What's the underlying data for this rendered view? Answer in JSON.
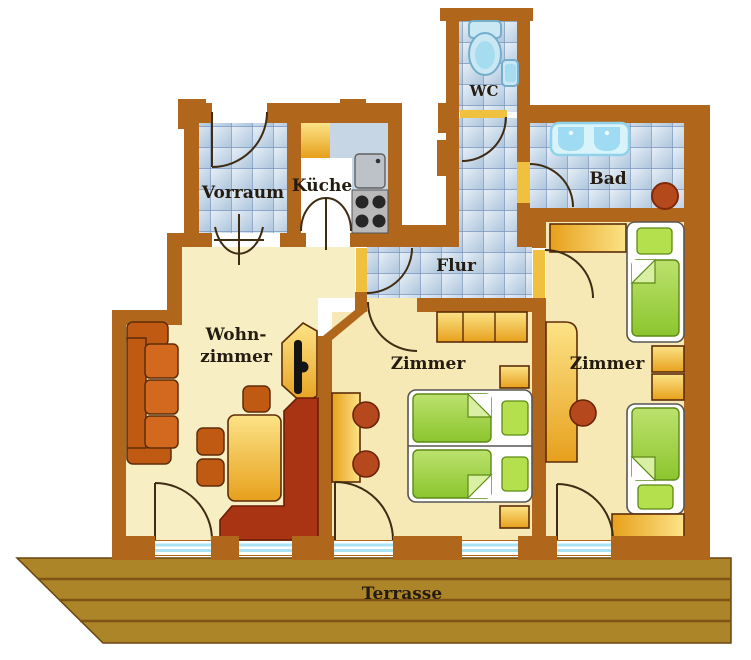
{
  "rooms": {
    "vorraum": {
      "label": "Vorraum"
    },
    "kueche": {
      "label": "Küche"
    },
    "wc": {
      "label": "WC"
    },
    "bad": {
      "label": "Bad"
    },
    "flur": {
      "label": "Flur"
    },
    "wohnzimmer": {
      "label_line1": "Wohn-",
      "label_line2": "zimmer"
    },
    "zimmer_mitte": {
      "label": "Zimmer"
    },
    "zimmer_rechts": {
      "label": "Zimmer"
    },
    "terrasse": {
      "label": "Terrasse"
    }
  },
  "colors": {
    "wall": "#b0671b",
    "floor": "#f8eec3",
    "floor_warm": "#f6e9b6",
    "kitchen_floor": "#ffffff",
    "tile_line": "#7592bb",
    "tile_light": "#e9f0f7",
    "tile_dark": "#aec6dd",
    "terrace": "#ac8529",
    "terrace_line": "#7d5316",
    "gold_light": "#fce387",
    "gold_dark": "#e7a01c",
    "orange": "#d2691e",
    "orange_dark": "#c05a12",
    "red_bench": "#a93413",
    "red_accent": "#b5481c",
    "green_light": "#c3e476",
    "green_dark": "#8cc52e",
    "fixture_blue": "#c9e8f4",
    "fixture_blue_deep": "#a5dcf0",
    "glazing": "#a9e2f2",
    "threshold": "#f0c13e",
    "text": "#241c10"
  }
}
